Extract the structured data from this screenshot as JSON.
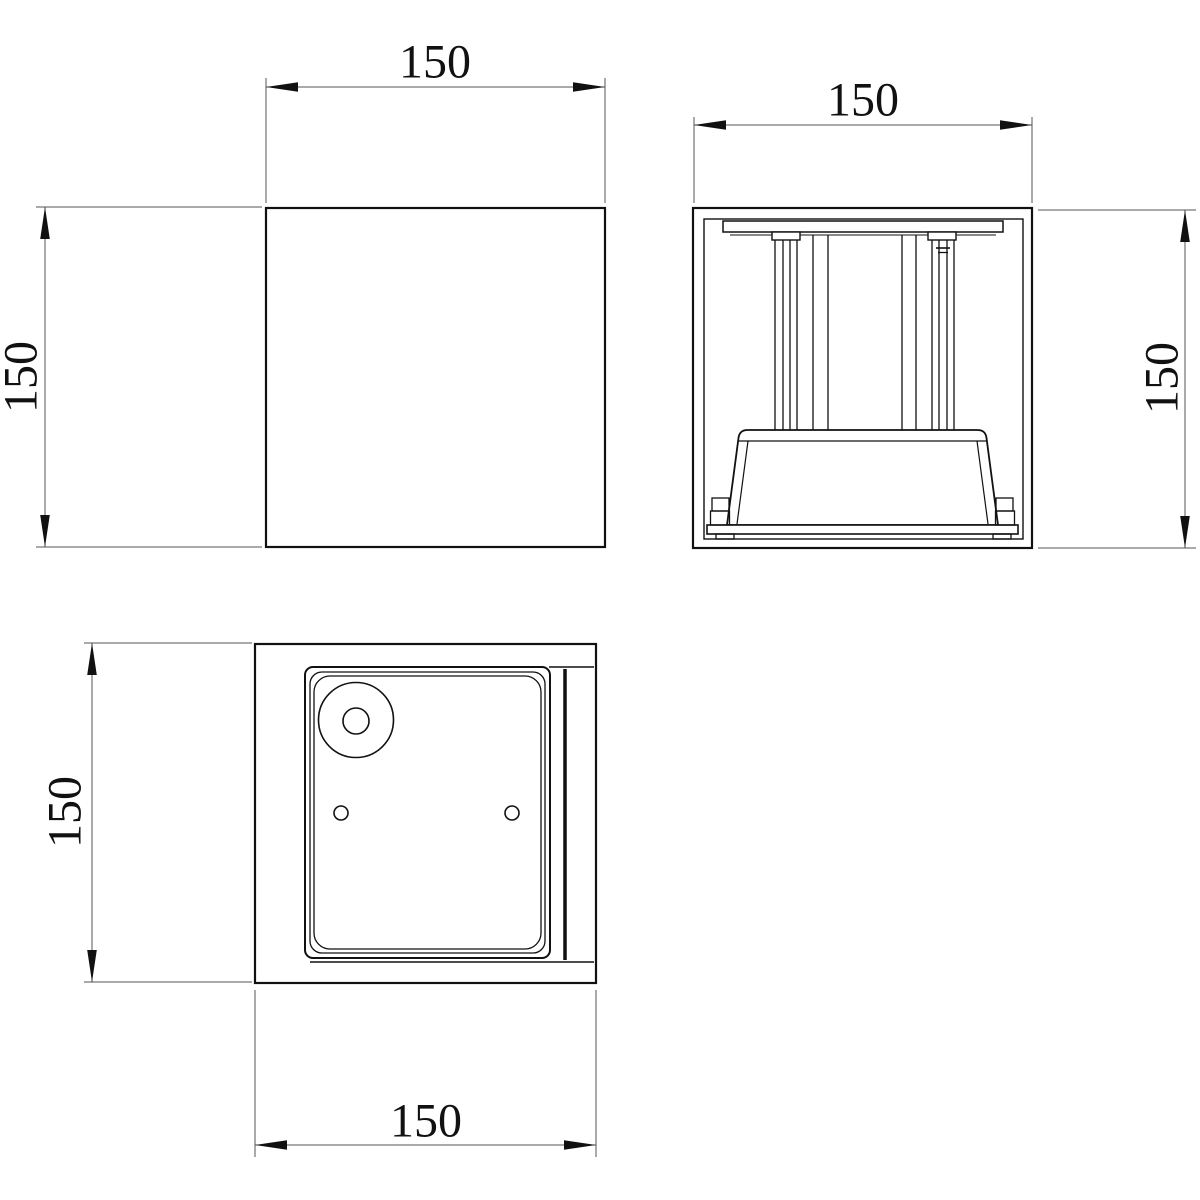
{
  "colors": {
    "background": "#ffffff",
    "object_line": "#111111",
    "dimension_line": "#555555",
    "text": "#111111"
  },
  "views": {
    "front": {
      "width_label": "150",
      "height_label": "150"
    },
    "side_section": {
      "width_label": "150",
      "height_label": "150"
    },
    "top": {
      "width_label": "150",
      "height_label": "150"
    }
  }
}
